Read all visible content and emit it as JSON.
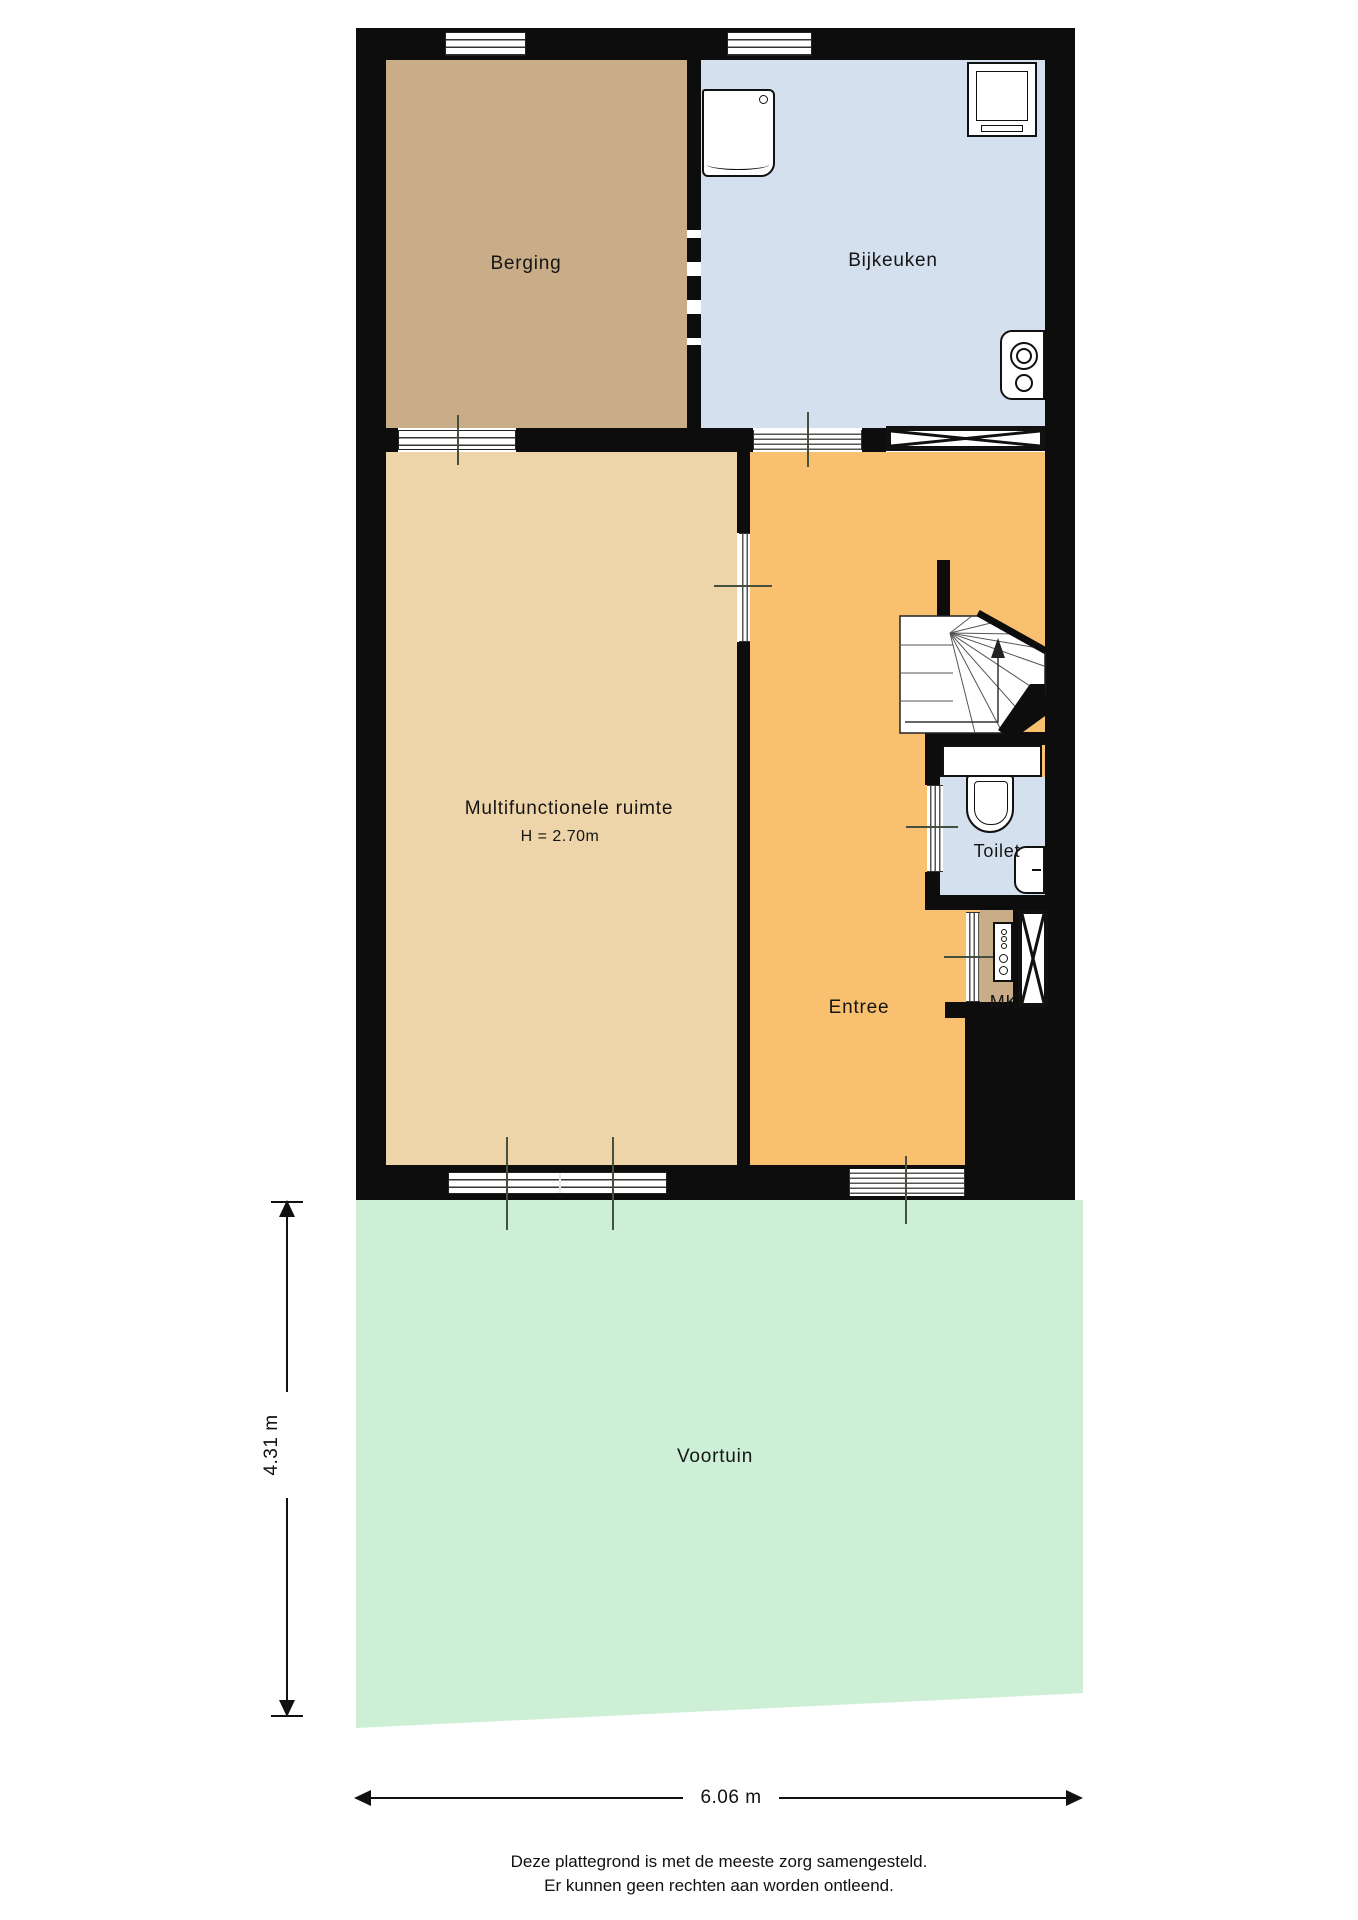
{
  "plan_title": "Begane grond plattegrond",
  "rooms": {
    "berging": {
      "label": "Berging"
    },
    "bijkeuken": {
      "label": "Bijkeuken"
    },
    "multifunctionele_ruimte": {
      "label": "Multifunctionele ruimte",
      "height_note": "H = 2.70m"
    },
    "entree": {
      "label": "Entree"
    },
    "toilet": {
      "label": "Toilet"
    },
    "meterkast": {
      "label": "MK"
    },
    "voortuin": {
      "label": "Voortuin"
    }
  },
  "dimensions": {
    "garden_depth": "4.31 m",
    "plot_width": "6.06 m"
  },
  "footer": {
    "line1": "Deze plattegrond is met de meeste zorg samengesteld.",
    "line2": "Er kunnen geen rechten aan worden ontleend."
  },
  "fixtures": [
    "washing-machine",
    "dryer",
    "boiler",
    "toilet-cistern",
    "toilet-bowl",
    "hand-basin",
    "fuse-panel",
    "stairs-up",
    "closet-x",
    "meter-closet-x"
  ],
  "colors": {
    "wall": "#0d0d0d",
    "berging": "#c9ac88",
    "bijkeuken": "#d4e0ee",
    "multi": "#eed4a9",
    "entree": "#f8c06f",
    "garden": "#ccefd6",
    "tick": "#45503f"
  }
}
